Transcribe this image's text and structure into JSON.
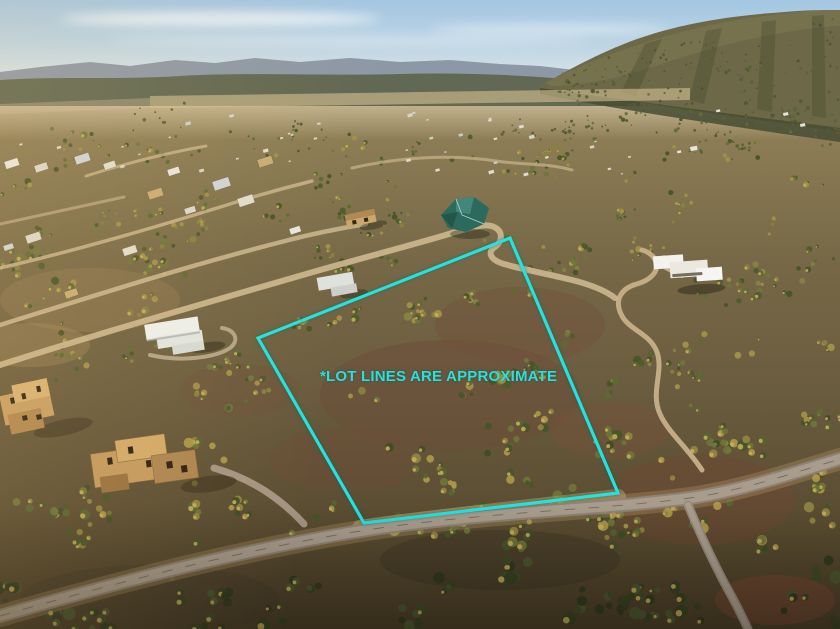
{
  "image": {
    "width": 840,
    "height": 629,
    "kind": "aerial-photo"
  },
  "overlay": {
    "disclaimer_text": "*LOT LINES ARE APPROXIMATE",
    "accent_color": "#24e2de",
    "lot_polygon_points": "510,238 258,338 364,523 618,493",
    "line_width": 3.2
  },
  "scene": {
    "palette": {
      "sky_top": "#a3c6e2",
      "sky_horizon": "#e9ece7",
      "far_ridge": "#8d98a6",
      "foothills": "#5f654e",
      "mountain": "#6c6848",
      "mountain_lit": "#7b7450",
      "mountain_shadow": "#474c33",
      "valley_haze": "#e8d8b6",
      "sunlit_sand": "#d6c193",
      "soil": "#6f4c39",
      "road_paved": "#a89d8d",
      "road_dirt": "#c7b088",
      "house_white": "#edf0ec",
      "house_adobe": "#c39a5e",
      "roof_teal": "#2d6a5e",
      "tree_highlight": "#cdb058",
      "tree_far": [
        "#59603a",
        "#4f572f",
        "#666c3d",
        "#5b6136"
      ],
      "tree_mid": [
        "#4e5c2d",
        "#5d6a33",
        "#6f773c",
        "#878242",
        "#a29147",
        "#475429"
      ],
      "tree_near": [
        "#45552a",
        "#566431",
        "#6d7538",
        "#8f8440",
        "#ab9747",
        "#3e4d26"
      ],
      "tree_dark": [
        "#344121",
        "#3d4a26",
        "#49562f",
        "#2e391d"
      ],
      "speck_colors": [
        "#e9e6dd",
        "#dcd8cc",
        "#cfd4d6",
        "#e2ddcf",
        "#c9ac74"
      ]
    }
  }
}
